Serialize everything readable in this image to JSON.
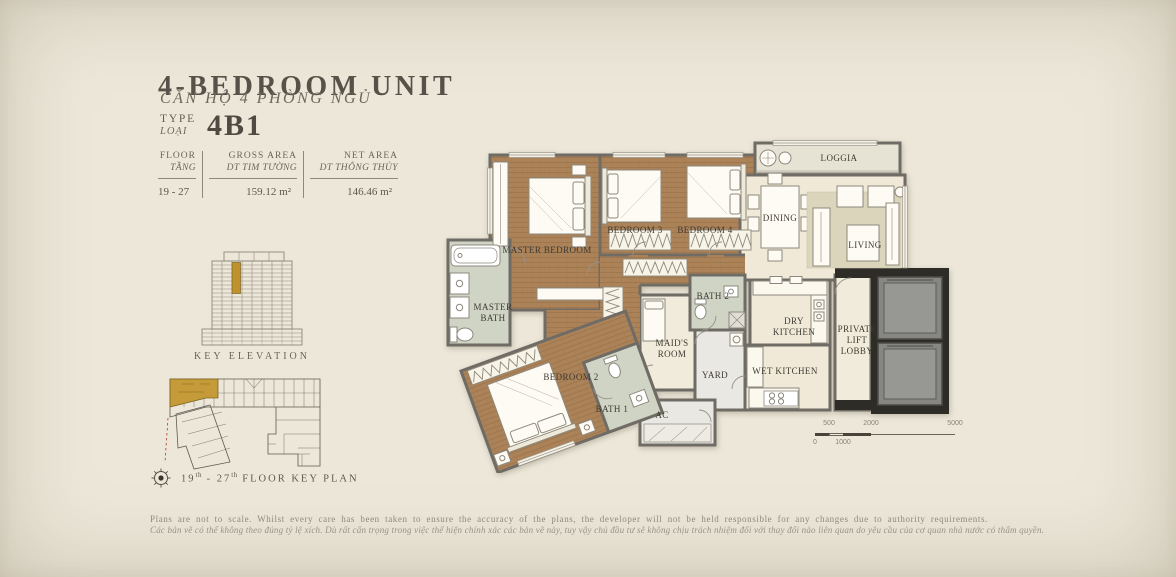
{
  "header": {
    "title": "4-BEDROOM UNIT",
    "subtitle_vi": "CĂN HỘ 4 PHÒNG NGỦ",
    "type": {
      "en": "TYPE",
      "vi": "LOẠI",
      "value": "4B1"
    }
  },
  "specs": {
    "columns": [
      {
        "en": "FLOOR",
        "vi": "TẦNG",
        "value": "19 - 27"
      },
      {
        "en": "GROSS AREA",
        "vi": "DT TIM TƯỜNG",
        "value": "159.12 m²"
      },
      {
        "en": "NET AREA",
        "vi": "DT THÔNG THỦY",
        "value": "146.46 m²"
      }
    ]
  },
  "key_elevation": {
    "caption": "KEY ELEVATION"
  },
  "key_plan": {
    "c1": "19",
    "sup1": "th",
    "c2": " - 27",
    "sup2": "th",
    "c3": " FLOOR KEY PLAN"
  },
  "plan": {
    "rooms": [
      {
        "label": "MASTER BEDROOM"
      },
      {
        "label": "BEDROOM 3"
      },
      {
        "label": "BEDROOM 4"
      },
      {
        "label": "LOGGIA"
      },
      {
        "label": "DINING"
      },
      {
        "label": "LIVING"
      },
      {
        "label": "MASTER BATH"
      },
      {
        "label": "BATH 2"
      },
      {
        "label": "DRY KITCHEN"
      },
      {
        "label": "PRIVATE LIFT LOBBY"
      },
      {
        "label": "WET KITCHEN"
      },
      {
        "label": "MAID'S ROOM"
      },
      {
        "label": "YARD"
      },
      {
        "label": "BEDROOM 2"
      },
      {
        "label": "BATH 1"
      },
      {
        "label": "AC"
      }
    ]
  },
  "scale_bar": {
    "labels": [
      "0",
      "500",
      "1000",
      "2000",
      "5000"
    ]
  },
  "disclaimer": {
    "en": "Plans are not to scale. Whilst every care has been taken to ensure the accuracy of the plans, the developer will not be held responsible for any changes due to authority requirements.",
    "vi": "Các bản vẽ có thể không theo đúng tỷ lệ xích. Dù rất cẩn trọng trong việc thể hiện chính xác các bản vẽ này, tuy vậy chủ đầu tư sẽ không chịu trách nhiệm đối với thay đổi nào liên quan do yêu cầu của cơ quan nhà nước có thẩm quyền."
  },
  "colors": {
    "accent_gold": "#c0922e",
    "wood_floor": "#ac8259",
    "tile_floor": "#cfd4c5",
    "wall_gray": "#6f6b65",
    "lift_shaft": "#2e2c27",
    "background": "#ece7d9"
  }
}
